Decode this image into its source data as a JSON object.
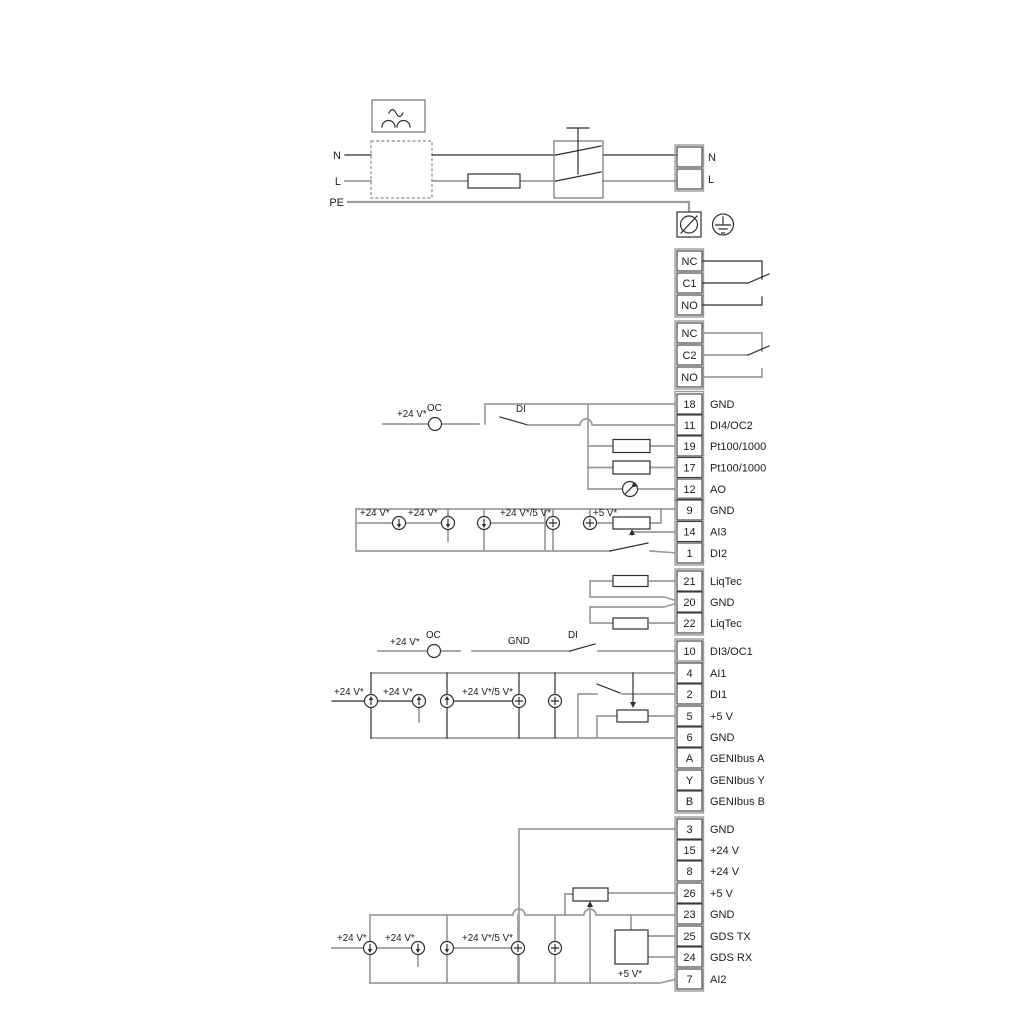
{
  "colors": {
    "background": "#ffffff",
    "wire_gray": "#9c9c9c",
    "wire_dark": "#2f2f2f",
    "text": "#1c1c1c"
  },
  "power": {
    "n_left": "N",
    "l_left": "L",
    "pe": "PE",
    "n_right": "N",
    "l_right": "L"
  },
  "relays": {
    "r1": [
      "NC",
      "C1",
      "NO"
    ],
    "r2": [
      "NC",
      "C2",
      "NO"
    ]
  },
  "terminals": {
    "io_top": [
      {
        "num": "18",
        "label": "GND"
      },
      {
        "num": "11",
        "label": "DI4/OC2"
      },
      {
        "num": "19",
        "label": "Pt100/1000"
      },
      {
        "num": "17",
        "label": "Pt100/1000"
      },
      {
        "num": "12",
        "label": "AO"
      }
    ],
    "analog1": [
      {
        "num": "9",
        "label": "GND"
      },
      {
        "num": "14",
        "label": "AI3"
      },
      {
        "num": "1",
        "label": "DI2"
      }
    ],
    "liqtec": [
      {
        "num": "21",
        "label": "LiqTec"
      },
      {
        "num": "20",
        "label": "GND"
      },
      {
        "num": "22",
        "label": "LiqTec"
      }
    ],
    "di3": [
      {
        "num": "10",
        "label": "DI3/OC1"
      }
    ],
    "analog2": [
      {
        "num": "4",
        "label": "AI1"
      },
      {
        "num": "2",
        "label": "DI1"
      },
      {
        "num": "5",
        "label": "+5 V"
      },
      {
        "num": "6",
        "label": "GND"
      },
      {
        "num": "A",
        "label": "GENIbus A"
      },
      {
        "num": "Y",
        "label": "GENIbus Y"
      },
      {
        "num": "B",
        "label": "GENIbus B"
      }
    ],
    "bottom": [
      {
        "num": "3",
        "label": "GND"
      },
      {
        "num": "15",
        "label": "+24 V"
      },
      {
        "num": "8",
        "label": "+24 V"
      },
      {
        "num": "26",
        "label": "+5 V"
      },
      {
        "num": "23",
        "label": "GND"
      },
      {
        "num": "25",
        "label": "GDS TX"
      },
      {
        "num": "24",
        "label": "GDS RX"
      },
      {
        "num": "7",
        "label": "AI2"
      }
    ]
  },
  "wire_labels": {
    "oc_top": {
      "v24": "+24 V*",
      "oc": "OC",
      "di": "DI"
    },
    "row_a": {
      "v24_1": "+24 V*",
      "v24_2": "+24 V*",
      "v24_5": "+24 V*/5 V*",
      "v5": "+5 V*"
    },
    "oc_mid": {
      "v24": "+24 V*",
      "oc": "OC",
      "gnd": "GND",
      "di": "DI"
    },
    "row_b": {
      "v24_1": "+24 V*",
      "v24_2": "+24 V*",
      "v24_5": "+24 V*/5 V*"
    },
    "row_c": {
      "v24_1": "+24 V*",
      "v24_2": "+24 V*",
      "v24_5": "+24 V*/5 V*",
      "v5": "+5 V*"
    }
  }
}
